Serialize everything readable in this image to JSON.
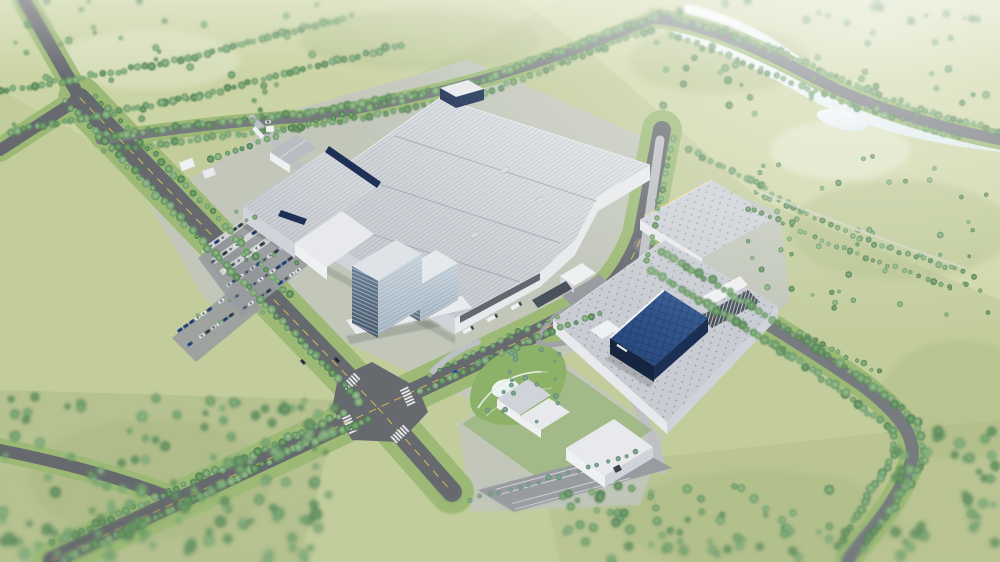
{
  "meta": {
    "type": "aerial-architectural-rendering",
    "subject": "industrial factory campus",
    "view": "oblique aerial",
    "style": "photorealistic 3d visualization with tilt-shift blur"
  },
  "scene": {
    "alt": "Aerial 3D rendering of a large industrial factory campus surrounded by green fields, tree-lined roads, a four-way intersection and a pond",
    "setting": "flat green countryside with tree-lined roads",
    "time_of_day": "daytime",
    "areas": {
      "main_factory": "large light-gray production halls with stepped metal roofs and navy fascia accents",
      "office_tower": "multi-storey glass office block at the factory front",
      "secondary_complex": "two warehouses with skylight-grid roofs",
      "blue_building": "navy-blue glass-roofed hall with white roof trim",
      "utility_buildings": "small white service buildings, gabled shed and gatehouse",
      "parking": "covered staff parking rows with cars and a striped visitor lot",
      "garden": "landscaped garden with small pond and curved footpaths",
      "water": "irregular reflective pond along the north-east road",
      "roads": "gray asphalt avenues with yellow center dashes and white zebra crosswalks meeting at a four-way intersection",
      "vegetation": "rows of street trees, orchard rows and scattered field trees"
    }
  },
  "palette": {
    "fieldBase": "#c3cd9c",
    "fieldLight": "#d2daab",
    "fieldDark": "#a9b883",
    "lawn": "#9cba76",
    "lawnBright": "#8cb168",
    "treeDark": "#4e7a4e",
    "treeMid": "#6f9c6b",
    "treeLight": "#93c08b",
    "bush": "#7fa98c",
    "road": "#66696e",
    "roadLight": "#777a7f",
    "concrete": "#c2c6c0",
    "apron": "#bdc0c4",
    "lot": "#989ba0",
    "roofBase": "#c4c8ce",
    "roofLight": "#e0e3e7",
    "roofSeam": "#a7acb3",
    "navy": "#1e3055",
    "blueRoof": "#2c4f85",
    "blueRoofDark": "#1c3a66",
    "blueWall": "#15243f",
    "white": "#eef0f2",
    "wall": "#e7e9ec",
    "wallShade": "#d0d4da",
    "glassDark": "#5c7286",
    "glassLight": "#b3c1cc",
    "pond": "#e4edef",
    "yellowLine": "#d9bd55",
    "dock": "#49515a",
    "carBlue": "#2857b8"
  }
}
